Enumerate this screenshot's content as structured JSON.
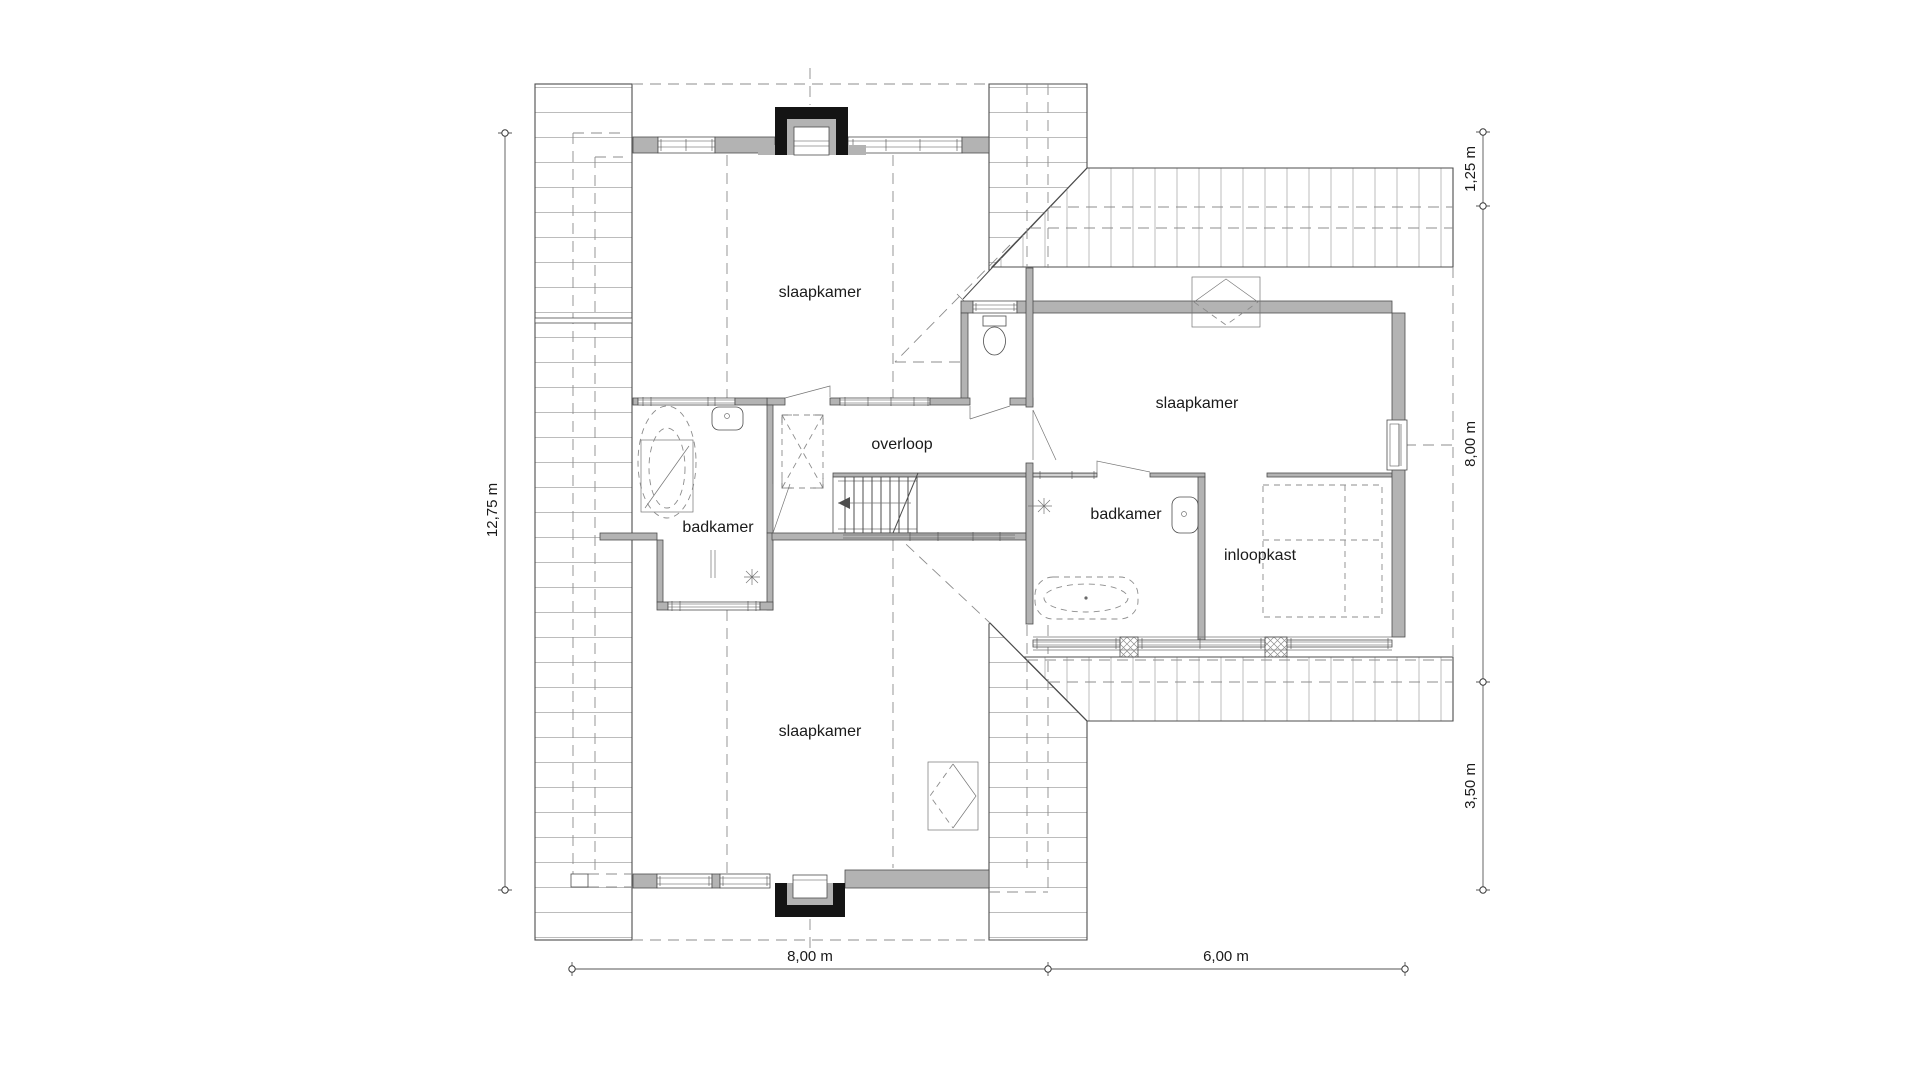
{
  "plan": {
    "rooms": {
      "bedroom_top": {
        "label": "slaapkamer"
      },
      "bedroom_right": {
        "label": "slaapkamer"
      },
      "bedroom_bottom": {
        "label": "slaapkamer"
      },
      "bathroom_left": {
        "label": "badkamer"
      },
      "bathroom_right": {
        "label": "badkamer"
      },
      "landing": {
        "label": "overloop"
      },
      "walk_in_closet": {
        "label": "inloopkast"
      }
    },
    "dimensions": {
      "left_total": "12,75 m",
      "right_top_offset": "1,25 m",
      "right_extension_depth": "8,00 m",
      "right_lower_offset": "3,50 m",
      "bottom_main_width": "8,00 m",
      "bottom_extension_width": "6,00 m"
    },
    "colors": {
      "background": "#ffffff",
      "wall_fill": "#b3b3b3",
      "line": "#4d4d4d",
      "hatch": "#bcbcbc",
      "dormer_frame": "#141414"
    }
  }
}
